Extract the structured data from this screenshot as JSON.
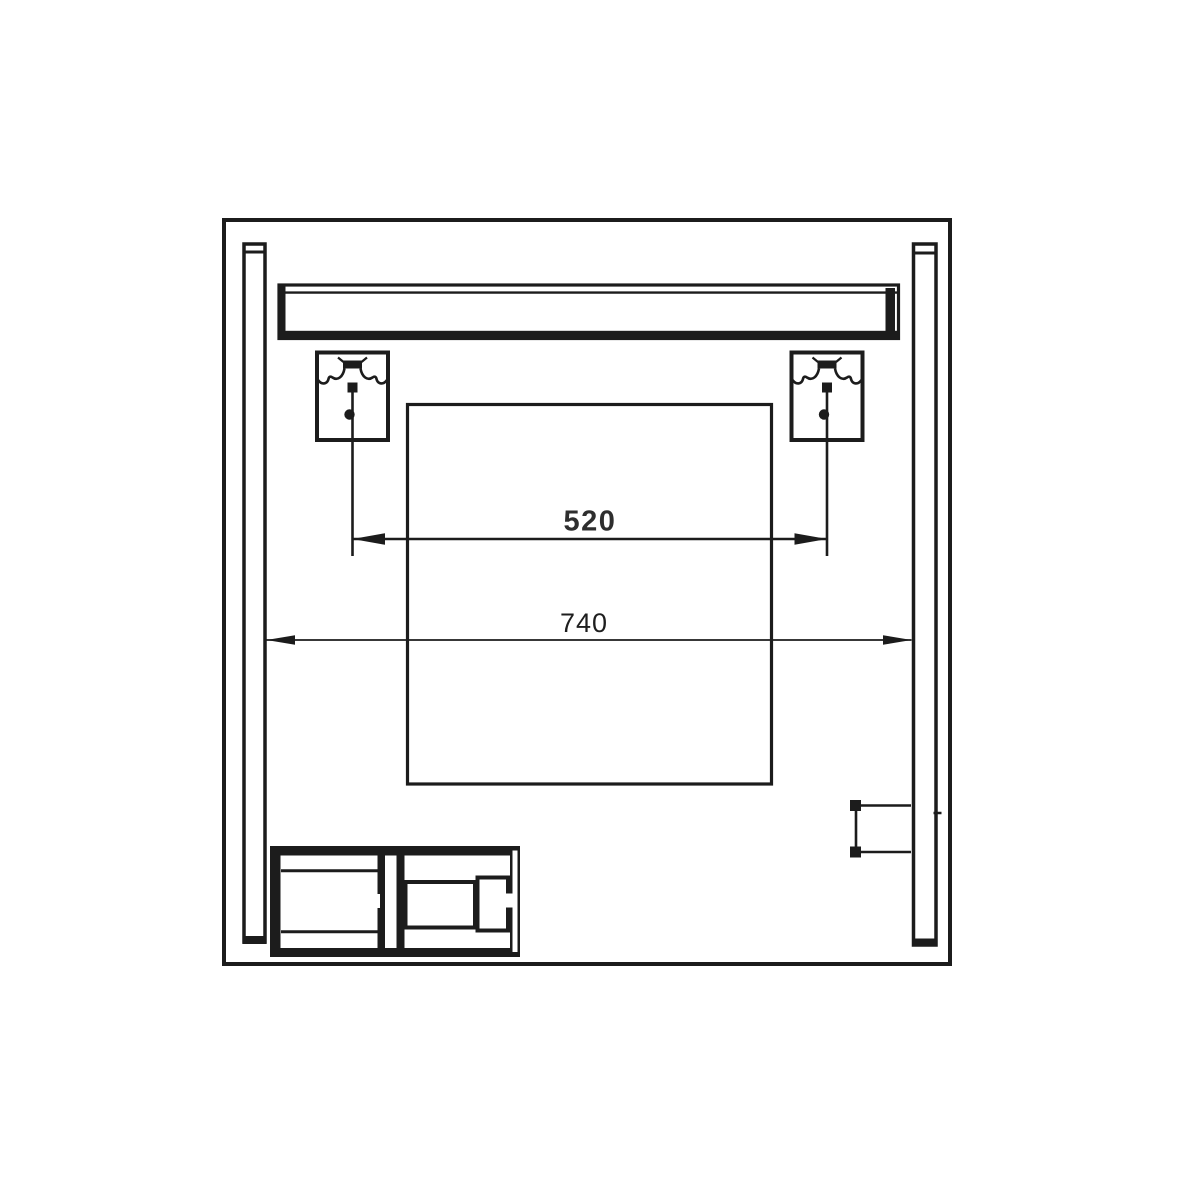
{
  "page": {
    "background": "#ffffff"
  },
  "drawing": {
    "kind": "technical-dimension-diagram",
    "labels": {
      "dim_bracket_spacing": "520",
      "dim_overall_width": "740"
    },
    "colors": {
      "line": "#1c1c1c",
      "background": "#ffffff",
      "dim_text_bold": "#2e2e2e",
      "dim_text_regular": "#1e1e1e"
    }
  }
}
